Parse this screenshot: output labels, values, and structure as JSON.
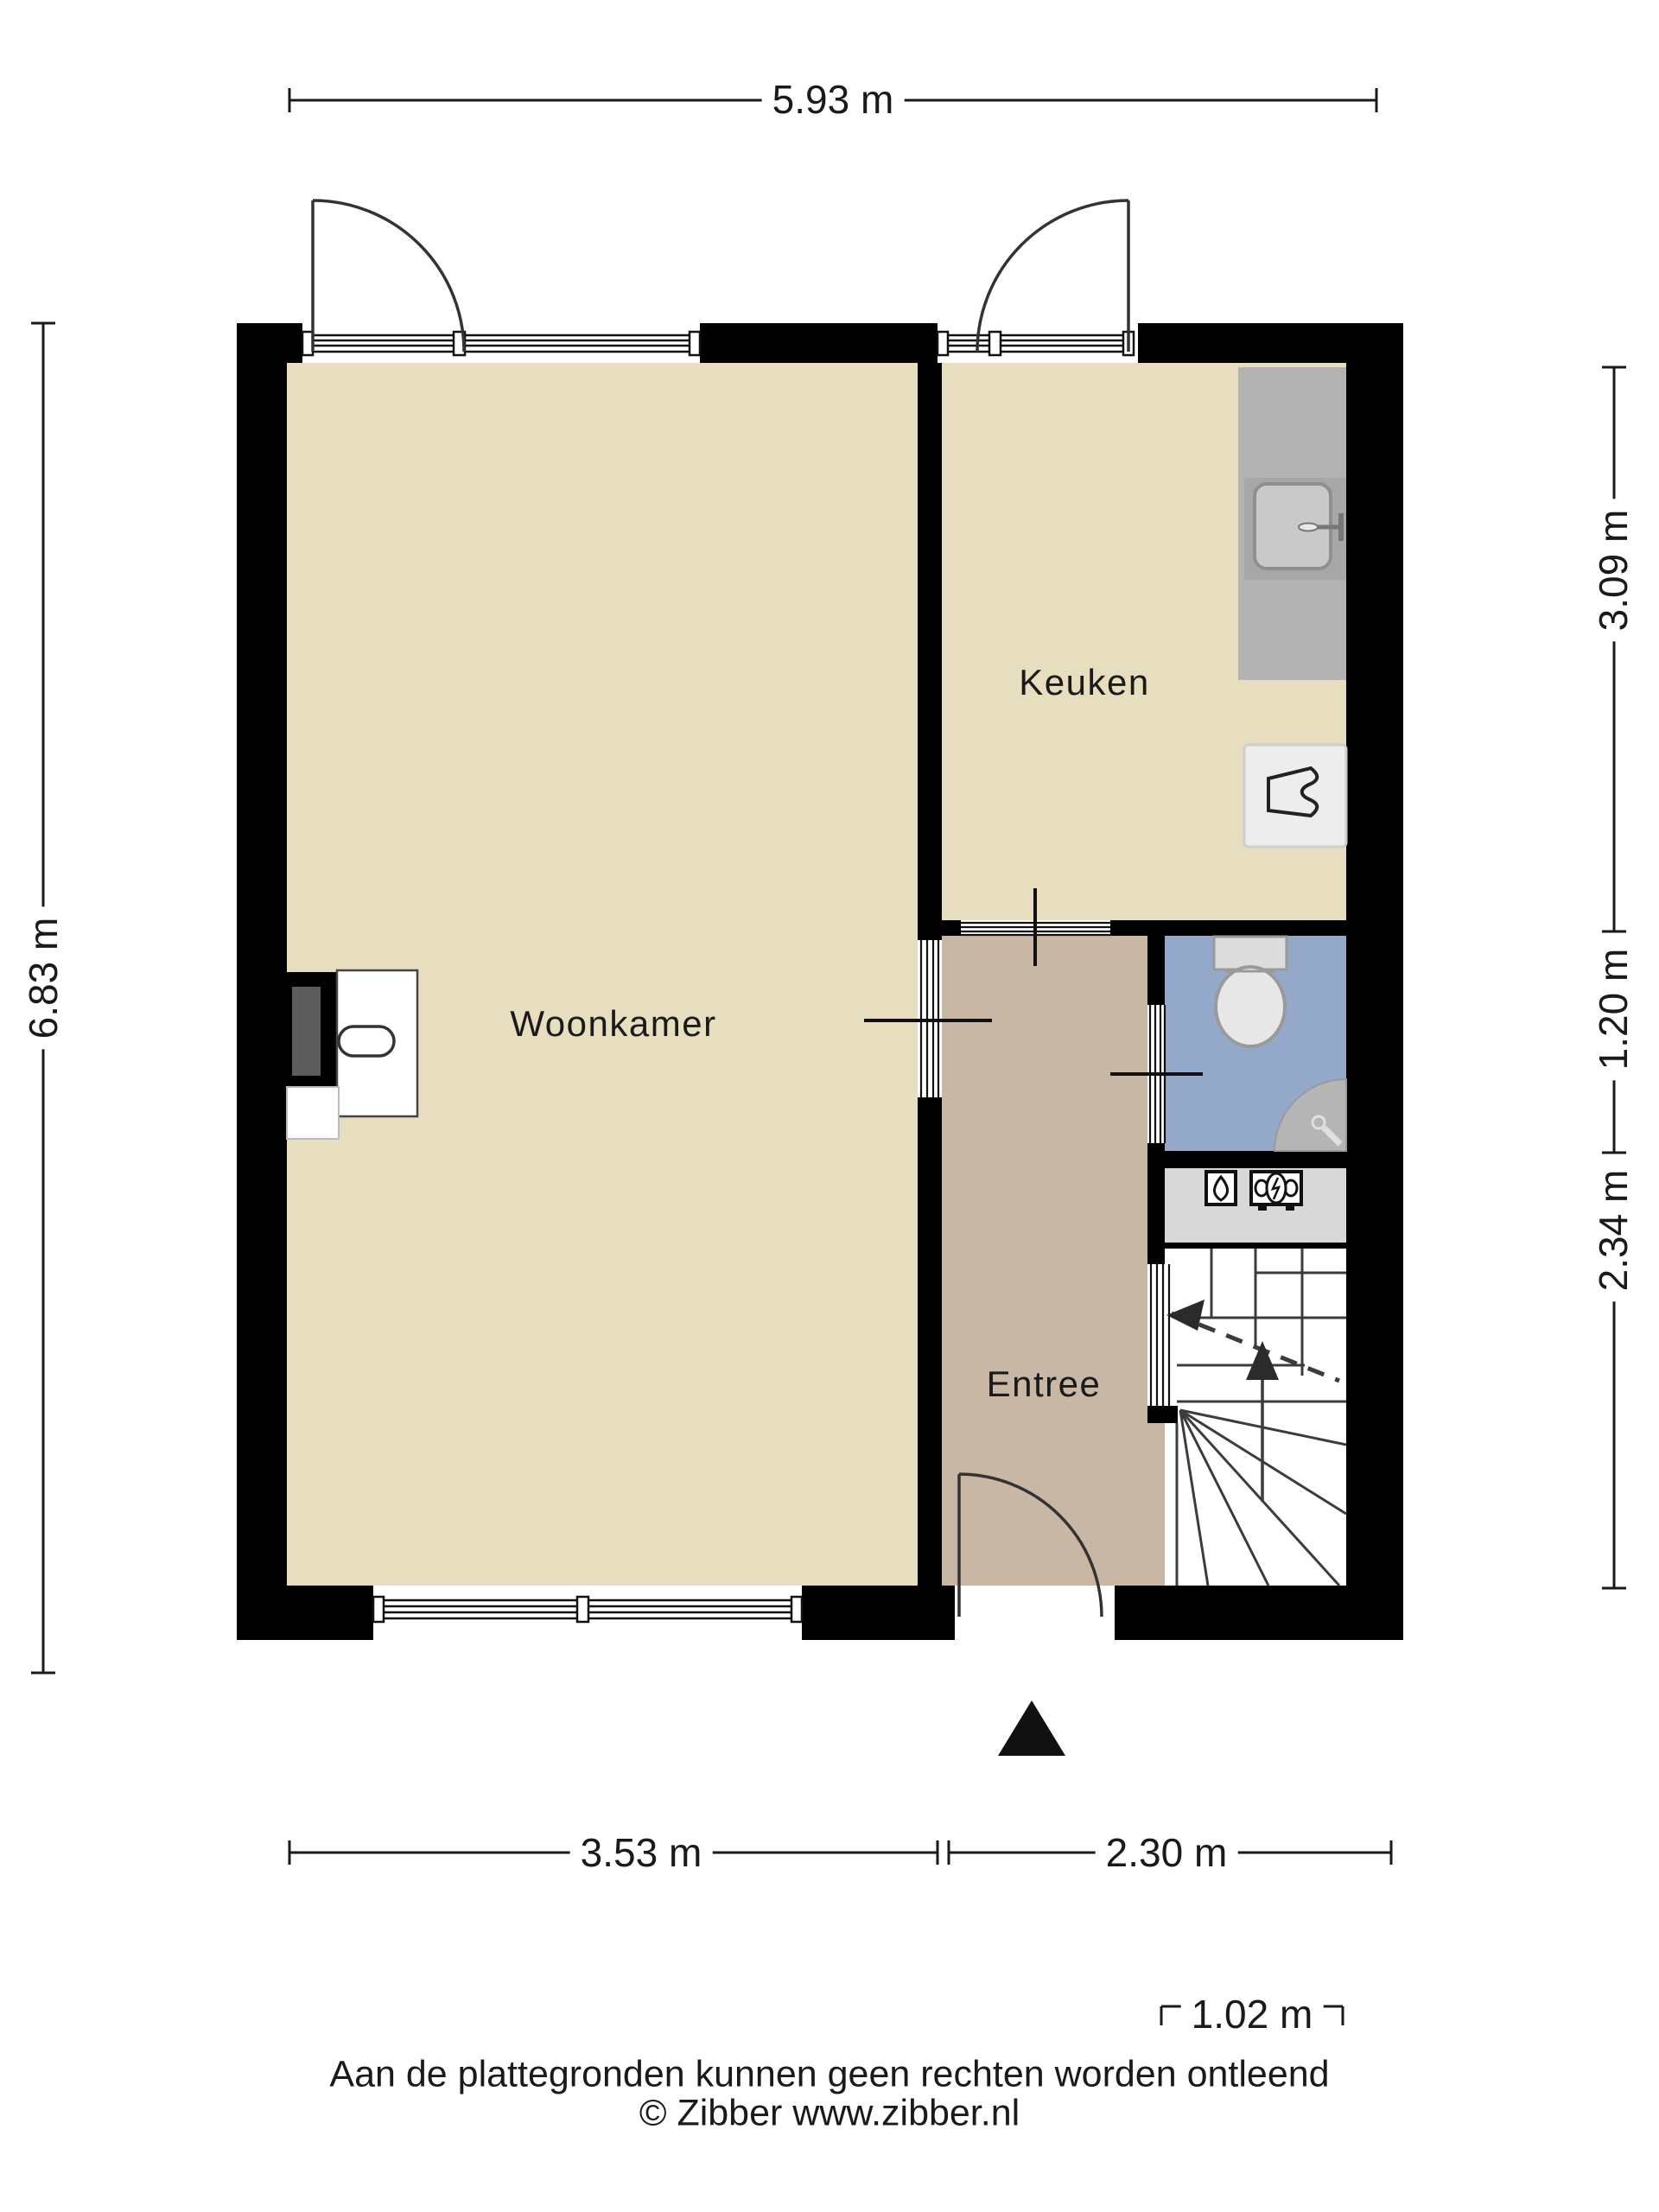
{
  "rooms": {
    "woonkamer": "Woonkamer",
    "keuken": "Keuken",
    "entree": "Entree"
  },
  "dimensions": {
    "top": "5.93 m",
    "left": "6.83 m",
    "right_top": "3.09 m",
    "right_middle": "1.20 m",
    "right_bottom": "2.34 m",
    "bottom_left": "3.53 m",
    "bottom_right": "2.30 m",
    "stair_width": "1.02 m"
  },
  "footer": {
    "disclaimer": "Aan de plattegronden kunnen geen rechten worden ontleend",
    "copyright": "© Zibber www.zibber.nl"
  },
  "colors": {
    "wall": "#000000",
    "floor-main": "#e6debf",
    "floor-entree": "#c8b7a4",
    "floor-toilet": "#94a9ca",
    "counter": "#b2b2b2",
    "counter-dark": "#a7a7a7",
    "sink": "#c9c9c9",
    "appliance": "#ededed",
    "meter-area": "#d8d8d8",
    "fixture": "#dcdcdc",
    "basin": "#b5b5b5",
    "line": "#1a1a1a",
    "stair-line": "#3c3c3c"
  },
  "icons": {
    "toilet": "toilet-top-view",
    "corner_washbasin": "corner-washbasin",
    "kitchen_sink": "kitchen-sink",
    "faucet": "faucet",
    "stove": "stove-symbol",
    "gas_meter": "gas-meter",
    "electric_meter": "electric-meter",
    "stairs_up_arrow": "stairs-up-arrow",
    "walk_line_arrow": "walk-line-arrow",
    "entrance_marker": "entrance-triangle",
    "fireplace": "fireplace-chimney"
  }
}
